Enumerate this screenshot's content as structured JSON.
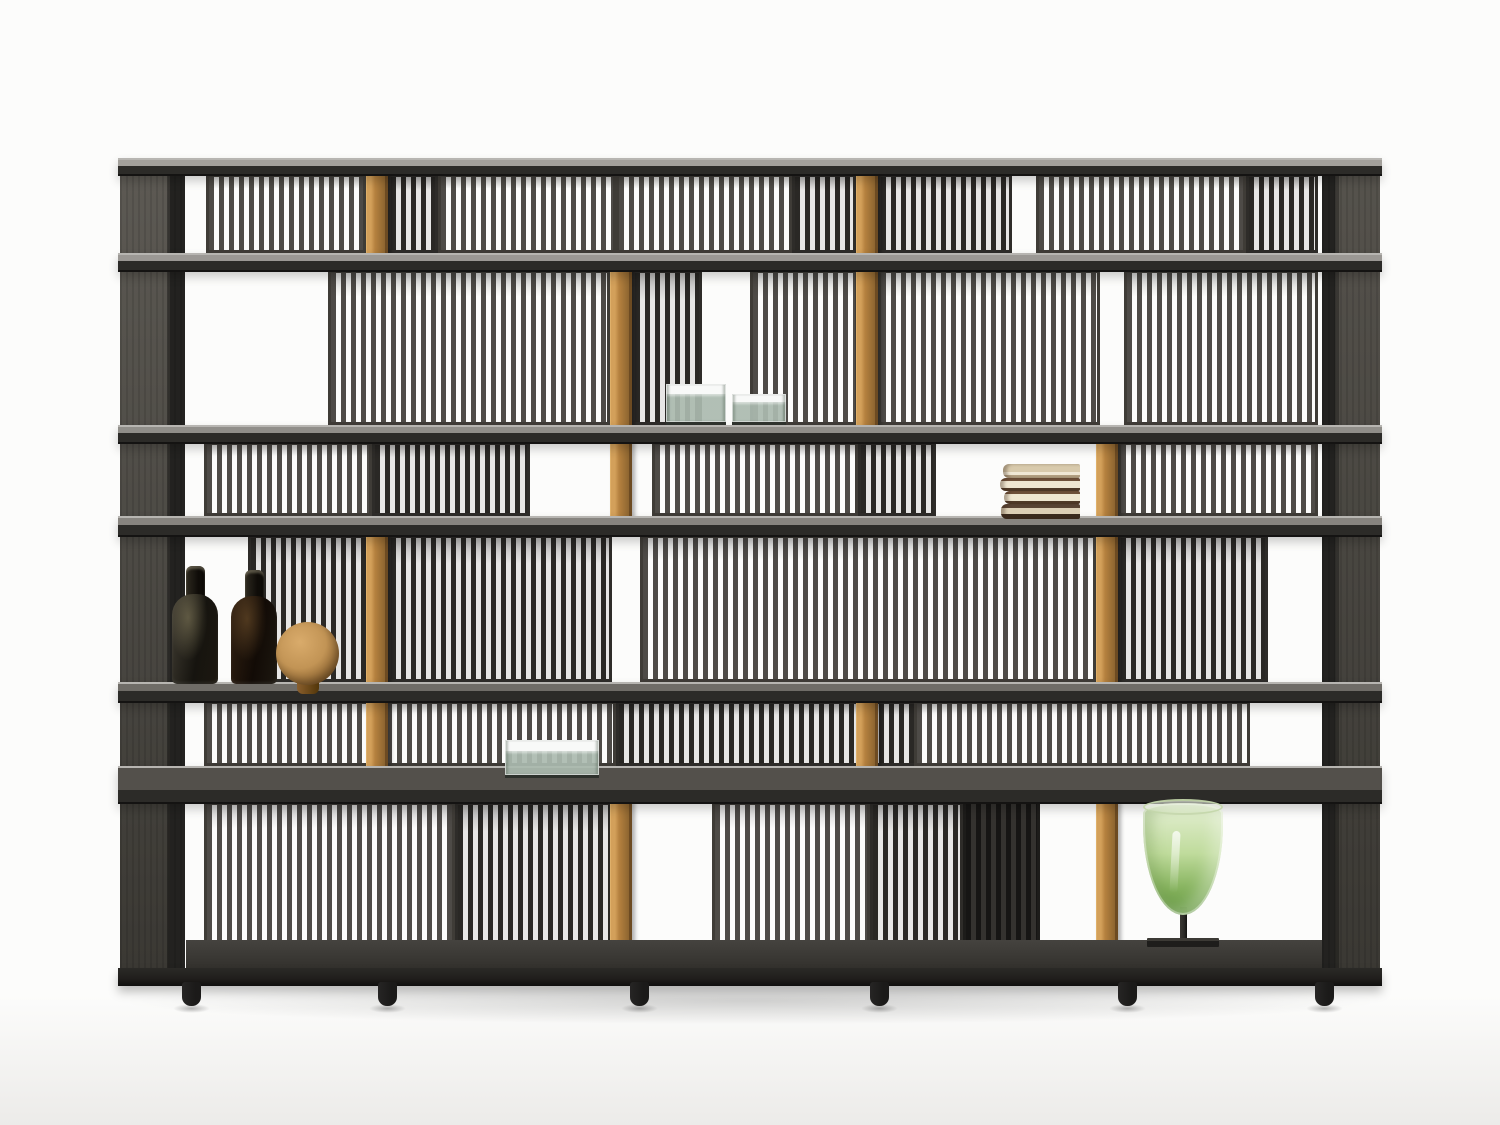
{
  "scene": {
    "kind": "furniture-product-photo",
    "subject": "modular-slatted-bookshelf",
    "background": "#fcfcfb",
    "floor_tint": "#ecebe9"
  },
  "palette": {
    "slat_front": "#4e4b47",
    "slat_back": "#2a2825",
    "rail_front": "#3f3c37",
    "rail_back": "#2e2c29",
    "bronze_light": "#d3a05a",
    "bronze_mid": "#b5813f",
    "bronze_dark": "#8d6530",
    "shelf_edge": "#2c2b28",
    "shelf_top_line": "#b7b5b1",
    "shelf_surfaces": [
      "#a3a09b",
      "#9b9894",
      "#908e89",
      "#87847f",
      "#6f6c67",
      "#53504b"
    ],
    "upright_face_top": "#5d5a54",
    "upright_face_bottom": "#3a3833",
    "upright_side": "#232220",
    "base_floor": "#45433f",
    "plinth": "#211f1d",
    "foot": "#1b1a19",
    "bottle_glass_1": "#3a362e",
    "bottle_glass_2": "#241d16",
    "oak_sphere": "#c29455",
    "book_pages": "#efe6d0",
    "book_cover_brown": "#5a4434",
    "book_cover_tan": "#d8caac",
    "glass_box_green": "#abbaaf",
    "glass_box_lid": "#f1f3f0",
    "goblet_green_top": "#deecc8",
    "goblet_green_bottom": "#5e943a",
    "goblet_stem": "#2b2a27"
  },
  "unit": {
    "x": 118,
    "width": 1264,
    "top": 158,
    "bottom": 986,
    "uprights": {
      "left": {
        "x": 120,
        "w": 65,
        "face_w": 47
      },
      "right": {
        "x": 1322,
        "w": 58,
        "edge_w": 13
      }
    },
    "shelves": [
      {
        "y": 158,
        "surface_h": 6,
        "edge_h": 8
      },
      {
        "y": 253,
        "surface_h": 6,
        "edge_h": 9
      },
      {
        "y": 425,
        "surface_h": 6,
        "edge_h": 9
      },
      {
        "y": 516,
        "surface_h": 7,
        "edge_h": 10
      },
      {
        "y": 682,
        "surface_h": 7,
        "edge_h": 10
      },
      {
        "y": 766,
        "surface_h": 22,
        "edge_h": 12
      }
    ],
    "rows": [
      {
        "y": 172,
        "h": 83,
        "panels": [
          [
            206,
            160,
            "front"
          ],
          [
            388,
            50,
            "back"
          ],
          [
            438,
            178,
            "front"
          ],
          [
            616,
            176,
            "front"
          ],
          [
            792,
            64,
            "back"
          ],
          [
            878,
            134,
            "back"
          ],
          [
            1036,
            210,
            "front"
          ],
          [
            1246,
            72,
            "back"
          ]
        ],
        "bronze": [
          366,
          856
        ]
      },
      {
        "y": 268,
        "h": 159,
        "panels": [
          [
            328,
            282,
            "front"
          ],
          [
            632,
            70,
            "back"
          ],
          [
            750,
            108,
            "front"
          ],
          [
            878,
            222,
            "front"
          ],
          [
            1124,
            194,
            "front"
          ]
        ],
        "bronze": [
          610,
          856
        ]
      },
      {
        "y": 440,
        "h": 78,
        "panels": [
          [
            204,
            168,
            "front"
          ],
          [
            372,
            158,
            "back"
          ],
          [
            652,
            206,
            "front"
          ],
          [
            858,
            78,
            "back"
          ],
          [
            1118,
            200,
            "front"
          ]
        ],
        "bronze": [
          610,
          1096
        ]
      },
      {
        "y": 533,
        "h": 151,
        "panels": [
          [
            248,
            124,
            "back"
          ],
          [
            388,
            224,
            "back"
          ],
          [
            640,
            456,
            "front"
          ],
          [
            1118,
            150,
            "back"
          ]
        ],
        "bronze": [
          366,
          1096
        ]
      },
      {
        "y": 699,
        "h": 69,
        "panels": [
          [
            204,
            412,
            "front"
          ],
          [
            616,
            302,
            "back"
          ],
          [
            914,
            336,
            "front"
          ]
        ],
        "bronze": [
          366,
          856
        ]
      },
      {
        "y": 800,
        "h": 158,
        "panels": [
          [
            204,
            251,
            "front"
          ],
          [
            455,
            160,
            "back"
          ],
          [
            712,
            158,
            "front"
          ],
          [
            870,
            93,
            "back"
          ],
          [
            963,
            77,
            "shadowp"
          ]
        ],
        "bronze": [
          610,
          1096
        ]
      }
    ],
    "base": {
      "floor_x": 186,
      "floor_w": 1136,
      "floor_y": 940,
      "floor_h": 28,
      "edge_y": 968,
      "edge_h": 18
    },
    "feet": {
      "xs": [
        182,
        378,
        630,
        870,
        1118,
        1315
      ],
      "y": 982,
      "w": 19,
      "h": 24
    }
  },
  "decor": {
    "bottles": [
      {
        "x": 172,
        "w": 46,
        "neck_x": 186,
        "neck_y": 566,
        "neck_w": 19,
        "body_y": 594,
        "body_h": 90,
        "tone": "olive"
      },
      {
        "x": 231,
        "w": 46,
        "neck_x": 245,
        "neck_y": 570,
        "neck_w": 19,
        "body_y": 596,
        "body_h": 88,
        "tone": "brown"
      }
    ],
    "sphere": {
      "x": 276,
      "y": 622,
      "d": 63,
      "foot_w": 22,
      "foot_h": 14
    },
    "glass_boxes": [
      {
        "x": 666,
        "y": 384,
        "w": 60,
        "h": 41,
        "lid_h": 10
      },
      {
        "x": 732,
        "y": 394,
        "w": 54,
        "h": 31,
        "lid_h": 8
      },
      {
        "x": 505,
        "y": 740,
        "w": 94,
        "h": 38,
        "lid_h": 11
      }
    ],
    "books": {
      "x": 1000,
      "y": 464,
      "w": 80,
      "heights": [
        14,
        13,
        13,
        15
      ],
      "offsets": [
        3,
        0,
        4,
        1
      ],
      "kinds": [
        "tan",
        "cream",
        "cream",
        "brown"
      ]
    },
    "goblet": {
      "x": 1143,
      "w": 80,
      "rim_y": 803,
      "bowl_h": 112,
      "stem_w": 7,
      "stem_h": 36,
      "plate_w": 72,
      "plate_h": 9,
      "plate_y": 938
    }
  }
}
